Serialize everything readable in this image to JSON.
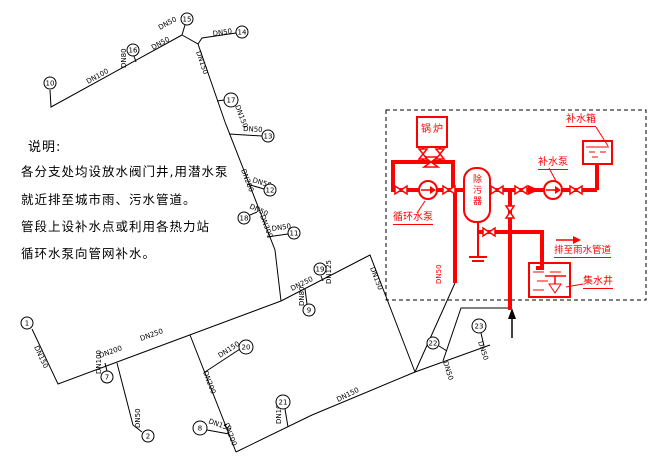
{
  "notes": {
    "title": "说明:",
    "lines": [
      "各分支处均设放水阀门井,用潜水泵",
      "就近排至城市雨、污水管道。",
      "管段上设补水点或利用各热力站",
      "循环水泵向管网补水。"
    ]
  },
  "schematic": {
    "accent_color": "#ff0000",
    "boiler_label": "锅炉",
    "strainer_label": "除污器",
    "circulation_pump_label": "循环水泵",
    "makeup_pump_label": "补水泵",
    "makeup_tank_label": "补水箱",
    "collection_well_label": "集水井",
    "discharge_label": "排至雨水管道",
    "riser_pipe_label": "DN50"
  },
  "network": {
    "nodes": [
      {
        "label": "10",
        "x": 50,
        "y": 83,
        "r": 6
      },
      {
        "label": "16",
        "x": 133,
        "y": 50,
        "r": 6
      },
      {
        "label": "15",
        "x": 187,
        "y": 19,
        "r": 6
      },
      {
        "label": "14",
        "x": 242,
        "y": 32,
        "r": 6
      },
      {
        "label": "17",
        "x": 231,
        "y": 100,
        "r": 7
      },
      {
        "label": "13",
        "x": 268,
        "y": 136,
        "r": 6
      },
      {
        "label": "12",
        "x": 270,
        "y": 190,
        "r": 6
      },
      {
        "label": "18",
        "x": 244,
        "y": 218,
        "r": 6
      },
      {
        "label": "11",
        "x": 294,
        "y": 233,
        "r": 6
      },
      {
        "label": "19",
        "x": 320,
        "y": 269,
        "r": 6
      },
      {
        "label": "9",
        "x": 309,
        "y": 310,
        "r": 6
      },
      {
        "label": "1",
        "x": 27,
        "y": 323,
        "r": 6
      },
      {
        "label": "7",
        "x": 107,
        "y": 377,
        "r": 6
      },
      {
        "label": "2",
        "x": 148,
        "y": 436,
        "r": 6
      },
      {
        "label": "8",
        "x": 200,
        "y": 428,
        "r": 7
      },
      {
        "label": "20",
        "x": 246,
        "y": 347,
        "r": 7
      },
      {
        "label": "21",
        "x": 283,
        "y": 402,
        "r": 7
      },
      {
        "label": "22",
        "x": 433,
        "y": 343,
        "r": 6
      },
      {
        "label": "23",
        "x": 479,
        "y": 326,
        "r": 7
      }
    ],
    "pipe_labels": [
      {
        "text": "DN100",
        "x": 88,
        "y": 84,
        "rot": -29
      },
      {
        "text": "DN80",
        "x": 126,
        "y": 68,
        "rot": -90
      },
      {
        "text": "DN50",
        "x": 160,
        "y": 30,
        "rot": -29
      },
      {
        "text": "DN50",
        "x": 153,
        "y": 50,
        "rot": -29
      },
      {
        "text": "DN50",
        "x": 213,
        "y": 36,
        "rot": -8
      },
      {
        "text": "DN150",
        "x": 196,
        "y": 52,
        "rot": 71
      },
      {
        "text": "DN150",
        "x": 235,
        "y": 106,
        "rot": 69
      },
      {
        "text": "DN200",
        "x": 241,
        "y": 170,
        "rot": 69
      },
      {
        "text": "DN300",
        "x": 260,
        "y": 216,
        "rot": 69
      },
      {
        "text": "DN50",
        "x": 243,
        "y": 131,
        "rot": 3
      },
      {
        "text": "DN50",
        "x": 252,
        "y": 182,
        "rot": 17
      },
      {
        "text": "DN50",
        "x": 249,
        "y": 208,
        "rot": 25
      },
      {
        "text": "DN50",
        "x": 272,
        "y": 231,
        "rot": -8
      },
      {
        "text": "DN125",
        "x": 331,
        "y": 284,
        "rot": -90
      },
      {
        "text": "DN80",
        "x": 304,
        "y": 306,
        "rot": -90
      },
      {
        "text": "DN250",
        "x": 292,
        "y": 291,
        "rot": -26
      },
      {
        "text": "DN150",
        "x": 370,
        "y": 268,
        "rot": 69
      },
      {
        "text": "DN150",
        "x": 34,
        "y": 347,
        "rot": 65
      },
      {
        "text": "DN200",
        "x": 100,
        "y": 358,
        "rot": -20
      },
      {
        "text": "DN250",
        "x": 141,
        "y": 341,
        "rot": -20
      },
      {
        "text": "DN100",
        "x": 101,
        "y": 374,
        "rot": -90
      },
      {
        "text": "DN200",
        "x": 203,
        "y": 372,
        "rot": 69
      },
      {
        "text": "DN200",
        "x": 224,
        "y": 424,
        "rot": 69
      },
      {
        "text": "DN150",
        "x": 220,
        "y": 358,
        "rot": -33
      },
      {
        "text": "DN150",
        "x": 208,
        "y": 423,
        "rot": 20
      },
      {
        "text": "DN100",
        "x": 281,
        "y": 424,
        "rot": -90
      },
      {
        "text": "DN50",
        "x": 140,
        "y": 428,
        "rot": -90
      },
      {
        "text": "DN150",
        "x": 338,
        "y": 402,
        "rot": -26
      },
      {
        "text": "DN50",
        "x": 443,
        "y": 362,
        "rot": 72
      },
      {
        "text": "DN50",
        "x": 478,
        "y": 342,
        "rot": 72
      },
      {
        "text": "DN50",
        "x": 441,
        "y": 284,
        "rot": -90,
        "red": true
      }
    ]
  }
}
